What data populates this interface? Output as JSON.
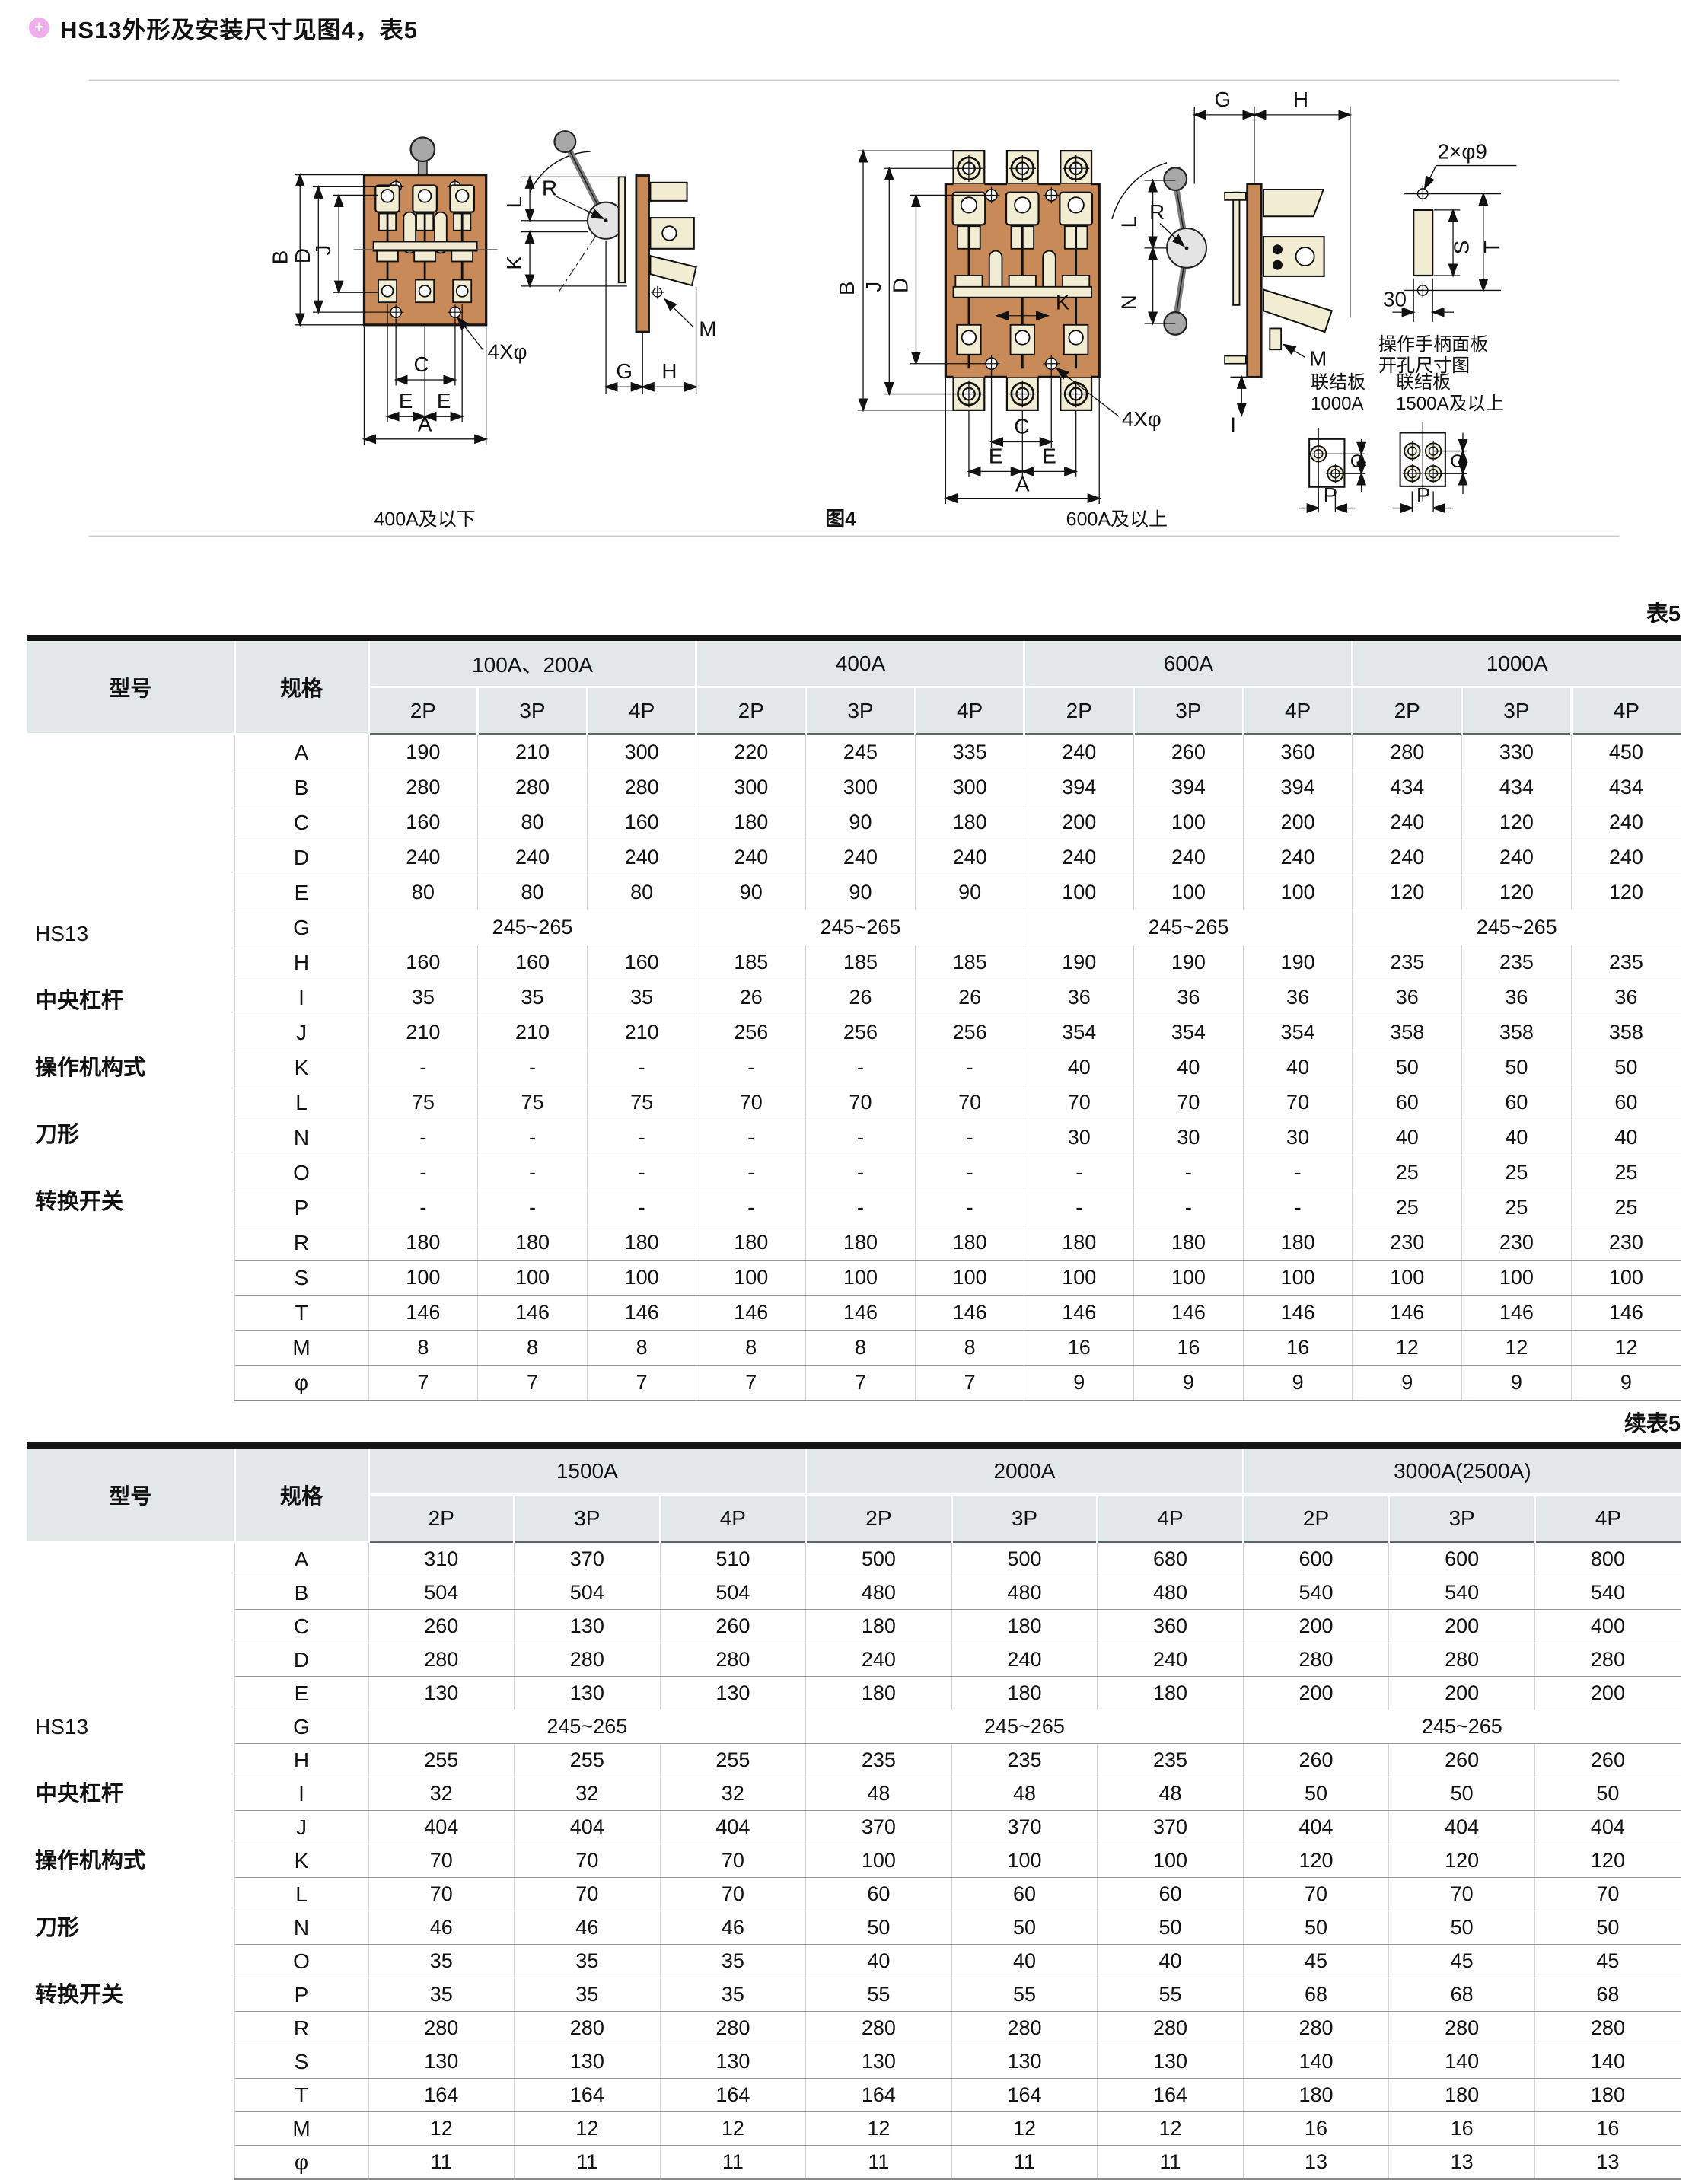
{
  "page": {
    "bullet": "+",
    "title": "HS13外形及安装尺寸见图4，表5"
  },
  "figure": {
    "caption_left": "400A及以下",
    "caption_center": "图4",
    "caption_right": "600A及以上",
    "bolt_note": "4Xφ",
    "panel_hole_note": "2×φ9",
    "panel_width_note": "30",
    "panel_caption_line1": "操作手柄面板",
    "panel_caption_line2": "开孔尺寸图",
    "link1_line1": "联结板",
    "link1_line2": "1000A",
    "link2_line1": "联结板",
    "link2_line2": "1500A及以上",
    "dims": {
      "A": "A",
      "B": "B",
      "C": "C",
      "D": "D",
      "E": "E",
      "G": "G",
      "H": "H",
      "I": "I",
      "J": "J",
      "K": "K",
      "L": "L",
      "M": "M",
      "N": "N",
      "O": "O",
      "P": "P",
      "R": "R",
      "S": "S",
      "T": "T"
    }
  },
  "table1": {
    "tag": "表5",
    "col_model": "型号",
    "col_spec": "规格",
    "model_lines": [
      "HS13",
      "中央杠杆",
      "操作机构式",
      "刀形",
      "转换开关"
    ],
    "groups": [
      {
        "label": "100A、200A",
        "subs": [
          "2P",
          "3P",
          "4P"
        ]
      },
      {
        "label": "400A",
        "subs": [
          "2P",
          "3P",
          "4P"
        ]
      },
      {
        "label": "600A",
        "subs": [
          "2P",
          "3P",
          "4P"
        ]
      },
      {
        "label": "1000A",
        "subs": [
          "2P",
          "3P",
          "4P"
        ]
      }
    ],
    "rows": [
      {
        "spec": "A",
        "values": [
          "190",
          "210",
          "300",
          "220",
          "245",
          "335",
          "240",
          "260",
          "360",
          "280",
          "330",
          "450"
        ]
      },
      {
        "spec": "B",
        "values": [
          "280",
          "280",
          "280",
          "300",
          "300",
          "300",
          "394",
          "394",
          "394",
          "434",
          "434",
          "434"
        ]
      },
      {
        "spec": "C",
        "values": [
          "160",
          "80",
          "160",
          "180",
          "90",
          "180",
          "200",
          "100",
          "200",
          "240",
          "120",
          "240"
        ]
      },
      {
        "spec": "D",
        "values": [
          "240",
          "240",
          "240",
          "240",
          "240",
          "240",
          "240",
          "240",
          "240",
          "240",
          "240",
          "240"
        ]
      },
      {
        "spec": "E",
        "values": [
          "80",
          "80",
          "80",
          "90",
          "90",
          "90",
          "100",
          "100",
          "100",
          "120",
          "120",
          "120"
        ]
      },
      {
        "spec": "G",
        "merged": [
          "245~265",
          "245~265",
          "245~265",
          "245~265"
        ]
      },
      {
        "spec": "H",
        "values": [
          "160",
          "160",
          "160",
          "185",
          "185",
          "185",
          "190",
          "190",
          "190",
          "235",
          "235",
          "235"
        ]
      },
      {
        "spec": "I",
        "values": [
          "35",
          "35",
          "35",
          "26",
          "26",
          "26",
          "36",
          "36",
          "36",
          "36",
          "36",
          "36"
        ]
      },
      {
        "spec": "J",
        "values": [
          "210",
          "210",
          "210",
          "256",
          "256",
          "256",
          "354",
          "354",
          "354",
          "358",
          "358",
          "358"
        ]
      },
      {
        "spec": "K",
        "values": [
          "-",
          "-",
          "-",
          "-",
          "-",
          "-",
          "40",
          "40",
          "40",
          "50",
          "50",
          "50"
        ]
      },
      {
        "spec": "L",
        "values": [
          "75",
          "75",
          "75",
          "70",
          "70",
          "70",
          "70",
          "70",
          "70",
          "60",
          "60",
          "60"
        ]
      },
      {
        "spec": "N",
        "values": [
          "-",
          "-",
          "-",
          "-",
          "-",
          "-",
          "30",
          "30",
          "30",
          "40",
          "40",
          "40"
        ]
      },
      {
        "spec": "O",
        "values": [
          "-",
          "-",
          "-",
          "-",
          "-",
          "-",
          "-",
          "-",
          "-",
          "25",
          "25",
          "25"
        ]
      },
      {
        "spec": "P",
        "values": [
          "-",
          "-",
          "-",
          "-",
          "-",
          "-",
          "-",
          "-",
          "-",
          "25",
          "25",
          "25"
        ]
      },
      {
        "spec": "R",
        "values": [
          "180",
          "180",
          "180",
          "180",
          "180",
          "180",
          "180",
          "180",
          "180",
          "230",
          "230",
          "230"
        ]
      },
      {
        "spec": "S",
        "values": [
          "100",
          "100",
          "100",
          "100",
          "100",
          "100",
          "100",
          "100",
          "100",
          "100",
          "100",
          "100"
        ]
      },
      {
        "spec": "T",
        "values": [
          "146",
          "146",
          "146",
          "146",
          "146",
          "146",
          "146",
          "146",
          "146",
          "146",
          "146",
          "146"
        ]
      },
      {
        "spec": "M",
        "values": [
          "8",
          "8",
          "8",
          "8",
          "8",
          "8",
          "16",
          "16",
          "16",
          "12",
          "12",
          "12"
        ]
      },
      {
        "spec": "φ",
        "values": [
          "7",
          "7",
          "7",
          "7",
          "7",
          "7",
          "9",
          "9",
          "9",
          "9",
          "9",
          "9"
        ]
      }
    ]
  },
  "table2": {
    "tag": "续表5",
    "col_model": "型号",
    "col_spec": "规格",
    "model_lines": [
      "HS13",
      "中央杠杆",
      "操作机构式",
      "刀形",
      "转换开关"
    ],
    "groups": [
      {
        "label": "1500A",
        "subs": [
          "2P",
          "3P",
          "4P"
        ]
      },
      {
        "label": "2000A",
        "subs": [
          "2P",
          "3P",
          "4P"
        ]
      },
      {
        "label": "3000A(2500A)",
        "subs": [
          "2P",
          "3P",
          "4P"
        ]
      }
    ],
    "rows": [
      {
        "spec": "A",
        "values": [
          "310",
          "370",
          "510",
          "500",
          "500",
          "680",
          "600",
          "600",
          "800"
        ]
      },
      {
        "spec": "B",
        "values": [
          "504",
          "504",
          "504",
          "480",
          "480",
          "480",
          "540",
          "540",
          "540"
        ]
      },
      {
        "spec": "C",
        "values": [
          "260",
          "130",
          "260",
          "180",
          "180",
          "360",
          "200",
          "200",
          "400"
        ]
      },
      {
        "spec": "D",
        "values": [
          "280",
          "280",
          "280",
          "240",
          "240",
          "240",
          "280",
          "280",
          "280"
        ]
      },
      {
        "spec": "E",
        "values": [
          "130",
          "130",
          "130",
          "180",
          "180",
          "180",
          "200",
          "200",
          "200"
        ]
      },
      {
        "spec": "G",
        "merged": [
          "245~265",
          "245~265",
          "245~265"
        ]
      },
      {
        "spec": "H",
        "values": [
          "255",
          "255",
          "255",
          "235",
          "235",
          "235",
          "260",
          "260",
          "260"
        ]
      },
      {
        "spec": "I",
        "values": [
          "32",
          "32",
          "32",
          "48",
          "48",
          "48",
          "50",
          "50",
          "50"
        ]
      },
      {
        "spec": "J",
        "values": [
          "404",
          "404",
          "404",
          "370",
          "370",
          "370",
          "404",
          "404",
          "404"
        ]
      },
      {
        "spec": "K",
        "values": [
          "70",
          "70",
          "70",
          "100",
          "100",
          "100",
          "120",
          "120",
          "120"
        ]
      },
      {
        "spec": "L",
        "values": [
          "70",
          "70",
          "70",
          "60",
          "60",
          "60",
          "70",
          "70",
          "70"
        ]
      },
      {
        "spec": "N",
        "values": [
          "46",
          "46",
          "46",
          "50",
          "50",
          "50",
          "50",
          "50",
          "50"
        ]
      },
      {
        "spec": "O",
        "values": [
          "35",
          "35",
          "35",
          "40",
          "40",
          "40",
          "45",
          "45",
          "45"
        ]
      },
      {
        "spec": "P",
        "values": [
          "35",
          "35",
          "35",
          "55",
          "55",
          "55",
          "68",
          "68",
          "68"
        ]
      },
      {
        "spec": "R",
        "values": [
          "280",
          "280",
          "280",
          "280",
          "280",
          "280",
          "280",
          "280",
          "280"
        ]
      },
      {
        "spec": "S",
        "values": [
          "130",
          "130",
          "130",
          "130",
          "130",
          "130",
          "140",
          "140",
          "140"
        ]
      },
      {
        "spec": "T",
        "values": [
          "164",
          "164",
          "164",
          "164",
          "164",
          "164",
          "180",
          "180",
          "180"
        ]
      },
      {
        "spec": "M",
        "values": [
          "12",
          "12",
          "12",
          "12",
          "12",
          "12",
          "16",
          "16",
          "16"
        ]
      },
      {
        "spec": "φ",
        "values": [
          "11",
          "11",
          "11",
          "11",
          "11",
          "11",
          "13",
          "13",
          "13"
        ]
      }
    ]
  }
}
